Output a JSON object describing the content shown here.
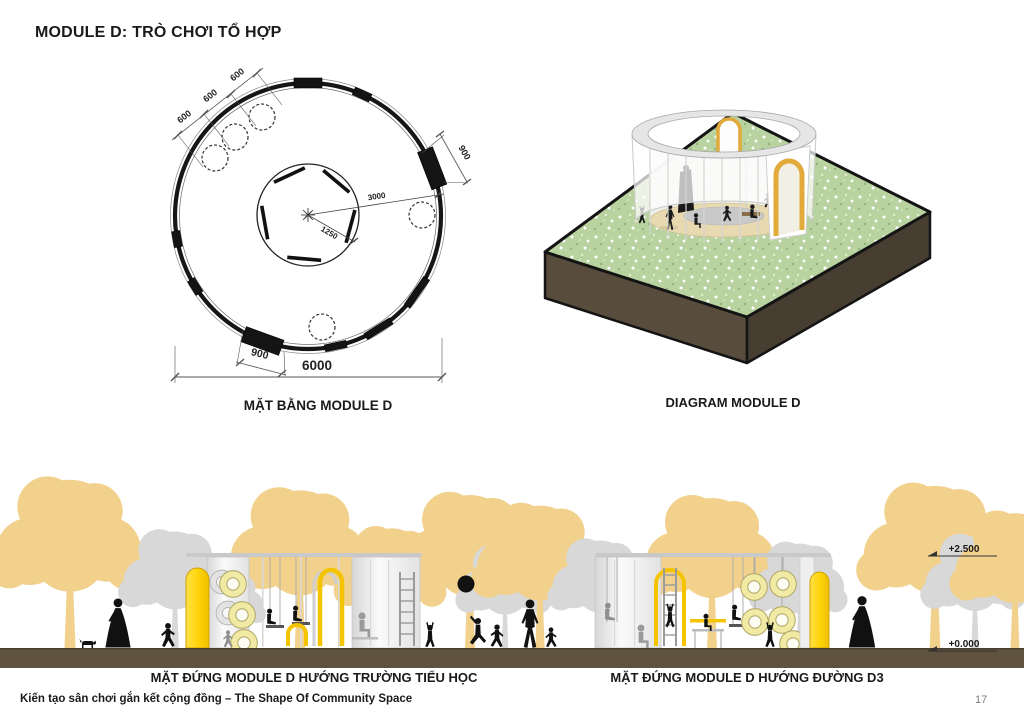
{
  "page": {
    "title": "MODULE D: TRÒ CHƠI TỔ HỢP",
    "footer": "Kiến tạo sân chơi gắn kết cộng đồng – The Shape Of Community Space",
    "page_number": "17"
  },
  "plan": {
    "caption": "MẶT BẰNG MODULE D",
    "dims": {
      "bay": "600",
      "opening": "900",
      "radius_outer": "3000",
      "radius_inner": "1250",
      "diameter": "6000"
    }
  },
  "diagram": {
    "caption": "DIAGRAM MODULE D"
  },
  "elevations": {
    "left": {
      "caption": "MẶT ĐỨNG MODULE D HƯỚNG TRƯỜNG TIỂU HỌC"
    },
    "right": {
      "caption": "MẶT ĐỨNG MODULE D HƯỚNG ĐƯỜNG D3"
    },
    "levels": {
      "top": "+2.500",
      "ground": "+0.000"
    }
  },
  "colors": {
    "accent_yellow": "#FFD40A",
    "arch_gold": "#E2A93B",
    "tree_yellow": "#F1D18C",
    "tree_gray": "#D8D8D8",
    "ground_brown": "#5F523F",
    "grass_green": "#B8D29E",
    "base_brown": "#4C4134",
    "tire_yellow": "#F1EAA4"
  }
}
